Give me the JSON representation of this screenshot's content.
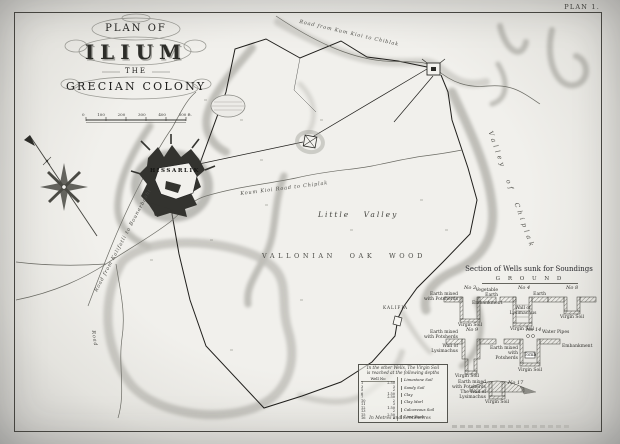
{
  "plate_label": "PLAN 1.",
  "title": {
    "line1": "PLAN OF",
    "line2": "ILIUM",
    "line3": "THE",
    "line4": "GRECIAN COLONY"
  },
  "scale": {
    "labels": [
      "0",
      "100",
      "200",
      "300",
      "400",
      "500 ft."
    ]
  },
  "map": {
    "hissarlik": "HISSARLIK",
    "little_valley": "Little Valley",
    "oak_wood": "VALLONIAN OAK WOOD",
    "valley_right": "Valley of Chiplak",
    "village": "KALIFIA",
    "road_top": "Road from Kum Kioi to Chiblak",
    "road_middle": "Koum Kioi Road to Chiplak",
    "road_left": "Road from Kalifatli to Bounarbashi",
    "road_bottom": "Road"
  },
  "wells": {
    "heading": "Section of Wells sunk for Soundings",
    "ground": "G R O U N D",
    "no2": "No 2",
    "no4": "No 4",
    "no8": "No 8",
    "no9": "No 9",
    "no14": "No 14",
    "no17": "No 17",
    "labels": {
      "w2_left": "Earth mixed with Potsherds",
      "w2_bottom": "Virgin Soil",
      "w4_top": "Vegetable Earth",
      "w4_left": "Embankment",
      "w4_mid": "Wall of Lysimachus",
      "w4_bottom": "Virgin Soil",
      "w8_top": "Earth",
      "w8_bottom": "Virgin Soil",
      "w9_left1": "Earth mixed with Potsherds",
      "w9_left2": "Wall of Lysimachus",
      "w9_bottom": "Virgin Soil",
      "w14_top": "Water Pipes",
      "w14_left": "Earth mixed with Potsherds",
      "w14_right": "Embankment",
      "w14_mid": "Tomb",
      "w14_bottom": "Virgin Soil",
      "w17_left1": "Earth mixed with Potsherds",
      "w17_left2": "The Wall of Lysimachus",
      "w17_bottom": "Virgin Soil"
    }
  },
  "depth_table": {
    "header1": "In the other Wells, The Virgin Soil",
    "header2": "is reached at the following depths",
    "col_no": "Well No",
    "rows": [
      [
        "1",
        "2.50"
      ],
      [
        "3",
        "3"
      ],
      [
        "5",
        "2"
      ],
      [
        "6",
        "1.50"
      ],
      [
        "7",
        "2.50"
      ],
      [
        "10",
        "2"
      ],
      [
        "11",
        "3"
      ],
      [
        "12",
        "1.50"
      ],
      [
        "13",
        "2"
      ],
      [
        "15",
        "2.50"
      ],
      [
        "16",
        "2"
      ]
    ],
    "soils": [
      "Limestone Soil",
      "Sandy Soil",
      "Clay",
      "Clay Marl",
      "Calcareous Soil",
      "Lime Rock"
    ],
    "footer": "In Metres and Centimetres"
  }
}
